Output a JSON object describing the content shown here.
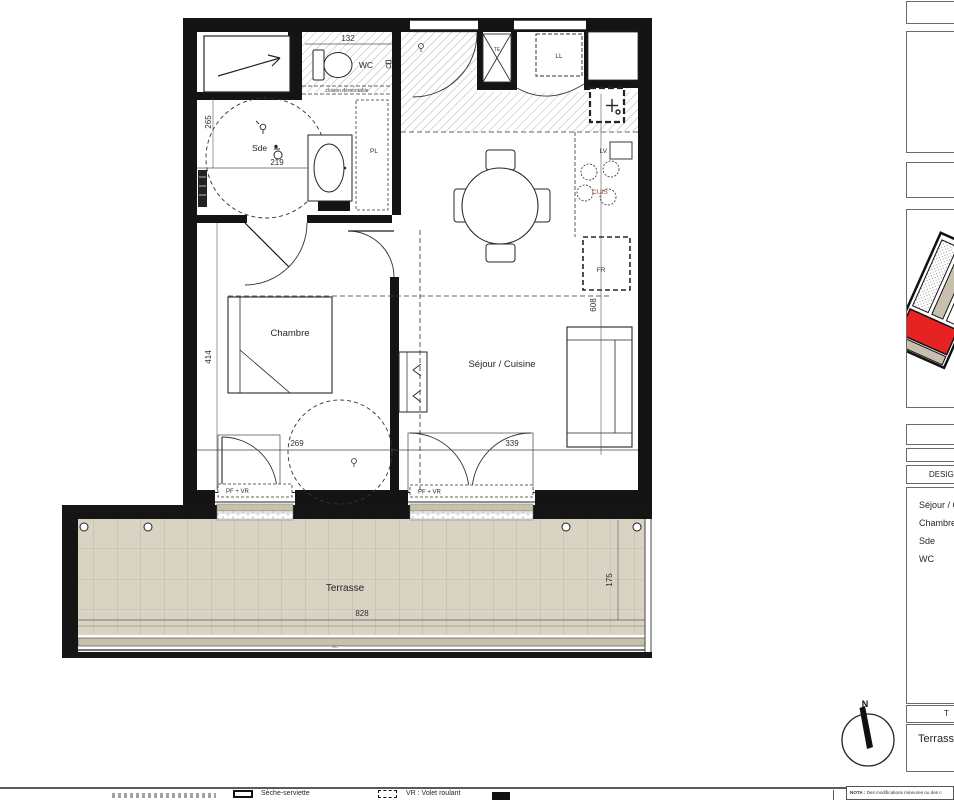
{
  "plan": {
    "rooms": {
      "wc": "WC",
      "sde": "Sde",
      "chambre": "Chambre",
      "sejour": "Séjour / Cuisine",
      "terrasse": "Terrasse"
    },
    "labels": {
      "cloison": "cloison démontable",
      "pl": "PL",
      "ll": "LL",
      "lv": "LV",
      "cuis": "CUIS",
      "fr": "FR",
      "te": "TE",
      "gc": "GC",
      "pf_vr": "PF + VR",
      "north": "N"
    },
    "dims": {
      "d132": "132",
      "d219": "219",
      "d265": "265",
      "d414": "414",
      "d269": "269",
      "d339": "339",
      "d608": "608",
      "d828": "828",
      "d175": "175"
    }
  },
  "sidebar": {
    "designation_header": "DESIGNATION",
    "room_list": [
      "Séjour / Cuisine",
      "Chambre",
      "Sde",
      "WC"
    ],
    "total_header": "T",
    "terrasse_row": "Terrasse"
  },
  "legend": {
    "items": [
      {
        "icon": "radiator-icon",
        "label": "Sèche-serviette"
      },
      {
        "icon": "shutter-dashed-box-icon",
        "label": "VR : Volet roulant"
      },
      {
        "icon": "solid-box-icon",
        "label": ""
      }
    ]
  },
  "nota": {
    "prefix": "NOTA :",
    "text": "Des modifications mineures ou des c"
  },
  "colors": {
    "wall": "#141414",
    "terrace_fill": "#d9d3c4",
    "highlight_red": "#e62222"
  }
}
